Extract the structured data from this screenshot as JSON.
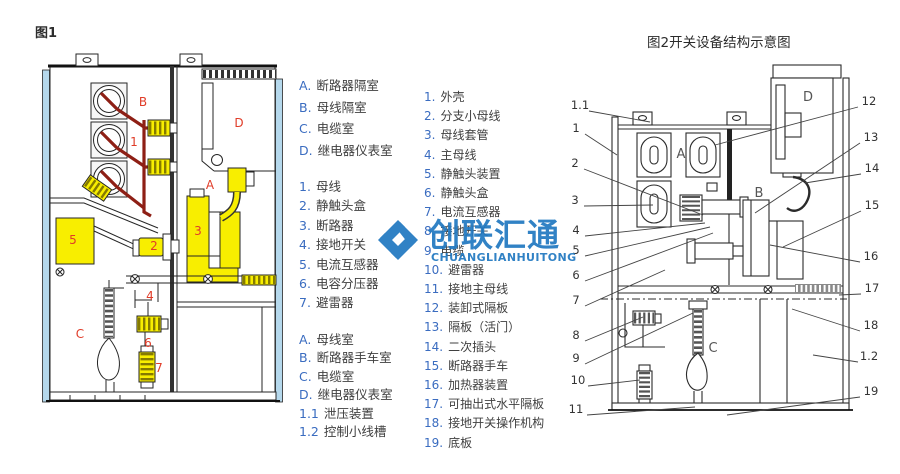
{
  "titles": {
    "fig1_caption": "图1",
    "legend1_title": "开关柜结构示意图",
    "fig2_caption": "图2开关设备结构示意图"
  },
  "legend1": {
    "rooms": [
      {
        "k": "A.",
        "t": "断路器隔室"
      },
      {
        "k": "B.",
        "t": "母线隔室"
      },
      {
        "k": "C.",
        "t": "电缆室"
      },
      {
        "k": "D.",
        "t": "继电器仪表室"
      }
    ],
    "parts": [
      {
        "k": "1.",
        "t": "母线"
      },
      {
        "k": "2.",
        "t": "静触头盒"
      },
      {
        "k": "3.",
        "t": "断路器"
      },
      {
        "k": "4.",
        "t": "接地开关"
      },
      {
        "k": "5.",
        "t": "电流互感器"
      },
      {
        "k": "6.",
        "t": "电容分压器"
      },
      {
        "k": "7.",
        "t": "避雷器"
      }
    ],
    "rooms2": [
      {
        "k": "A.",
        "t": "母线室"
      },
      {
        "k": "B.",
        "t": "断路器手车室"
      },
      {
        "k": "C.",
        "t": "电缆室"
      },
      {
        "k": "D.",
        "t": "继电器仪表室"
      },
      {
        "k": "1.1",
        "t": "泄压装置"
      },
      {
        "k": "1.2",
        "t": "控制小线槽"
      }
    ]
  },
  "legend2": {
    "items": [
      {
        "k": "1.",
        "t": "外壳"
      },
      {
        "k": "2.",
        "t": "分支小母线"
      },
      {
        "k": "3.",
        "t": "母线套管"
      },
      {
        "k": "4.",
        "t": "主母线"
      },
      {
        "k": "5.",
        "t": "静触头装置"
      },
      {
        "k": "6.",
        "t": "静触头盒"
      },
      {
        "k": "7.",
        "t": "电流互感器"
      },
      {
        "k": "8.",
        "t": "接地开关"
      },
      {
        "k": "9.",
        "t": "电缆"
      },
      {
        "k": "10.",
        "t": "避雷器"
      },
      {
        "k": "11.",
        "t": "接地主母线"
      },
      {
        "k": "12.",
        "t": "装卸式隔板"
      },
      {
        "k": "13.",
        "t": "隔板（活门）"
      },
      {
        "k": "14.",
        "t": "二次插头"
      },
      {
        "k": "15.",
        "t": "断路器手车"
      },
      {
        "k": "16.",
        "t": "加热器装置"
      },
      {
        "k": "17.",
        "t": "可抽出式水平隔板"
      },
      {
        "k": "18.",
        "t": "接地开关操作机构"
      },
      {
        "k": "19.",
        "t": "底板"
      }
    ]
  },
  "fig1_labels": {
    "B": "B",
    "n1": "1",
    "D": "D",
    "A": "A",
    "n5": "5",
    "n2": "2",
    "n3": "3",
    "C": "C",
    "n4": "4",
    "n6": "6",
    "n7": "7"
  },
  "fig2_labels": {
    "A": "A",
    "B": "B",
    "C": "C",
    "D": "D"
  },
  "fig2_callouts_left": [
    "1.1",
    "1",
    "2",
    "3",
    "4",
    "5",
    "6",
    "7",
    "8",
    "9",
    "10",
    "11"
  ],
  "fig2_callouts_right": [
    "12",
    "13",
    "14",
    "15",
    "16",
    "17",
    "18",
    "1.2",
    "19"
  ],
  "watermark": {
    "cn": "创联汇通",
    "en": "CHUANGLIANHUITONG"
  },
  "colors": {
    "accent_blue": "#3a6cc0",
    "title_blue": "#1c55ae",
    "label_red": "#e03c28",
    "busbar_red": "#8e1f15",
    "component_yellow": "#f8ee00",
    "panel_blue": "#b5d8ec",
    "watermark_blue": "#2279c1"
  }
}
